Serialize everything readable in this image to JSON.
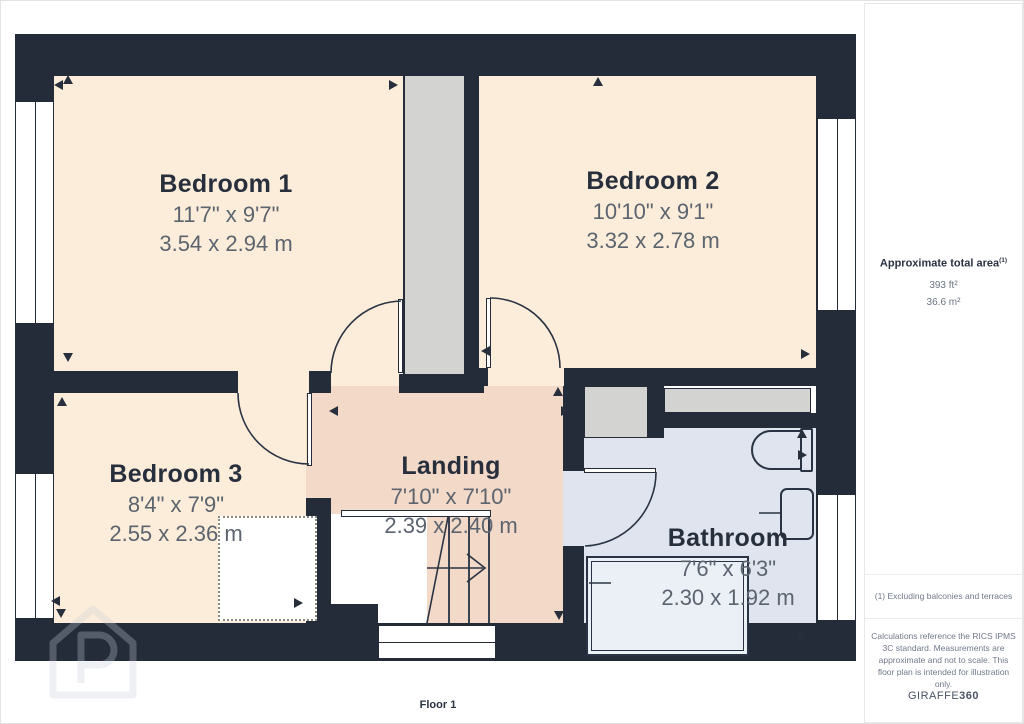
{
  "plan": {
    "floor_label": "Floor 1",
    "rooms": [
      {
        "id": "bedroom1",
        "name": "Bedroom 1",
        "imperial": "11'7\" x 9'7\"",
        "metric": "3.54 x 2.94 m"
      },
      {
        "id": "bedroom2",
        "name": "Bedroom 2",
        "imperial": "10'10\" x 9'1\"",
        "metric": "3.32 x 2.78 m"
      },
      {
        "id": "bedroom3",
        "name": "Bedroom 3",
        "imperial": "8'4\" x 7'9\"",
        "metric": "2.55 x 2.36 m"
      },
      {
        "id": "landing",
        "name": "Landing",
        "imperial": "7'10\" x 7'10\"",
        "metric": "2.39 x 2.40 m"
      },
      {
        "id": "bathroom",
        "name": "Bathroom",
        "imperial": "7'6\" x 6'3\"",
        "metric": "2.30 x 1.92 m"
      }
    ]
  },
  "sidebar": {
    "area_title": "Approximate total area",
    "area_footnote_marker": "(1)",
    "area_ft": "393 ft²",
    "area_m": "36.6 m²",
    "note1": "(1) Excluding balconies and terraces",
    "disclaimer": "Calculations reference the RICS IPMS 3C standard. Measurements are approximate and not to scale. This floor plan is intended for illustration only.",
    "brand_prefix": "GIRAFFE",
    "brand_suffix": "360"
  },
  "colors": {
    "wall": "#242c3a",
    "bedroom_fill": "#fcedda",
    "landing_fill": "#f3d9c7",
    "bathroom_fill": "#dfe4ee",
    "shaft_fill": "#d3d3d2",
    "room_name_text": "#272f3d",
    "dimension_text": "#5c646f"
  }
}
